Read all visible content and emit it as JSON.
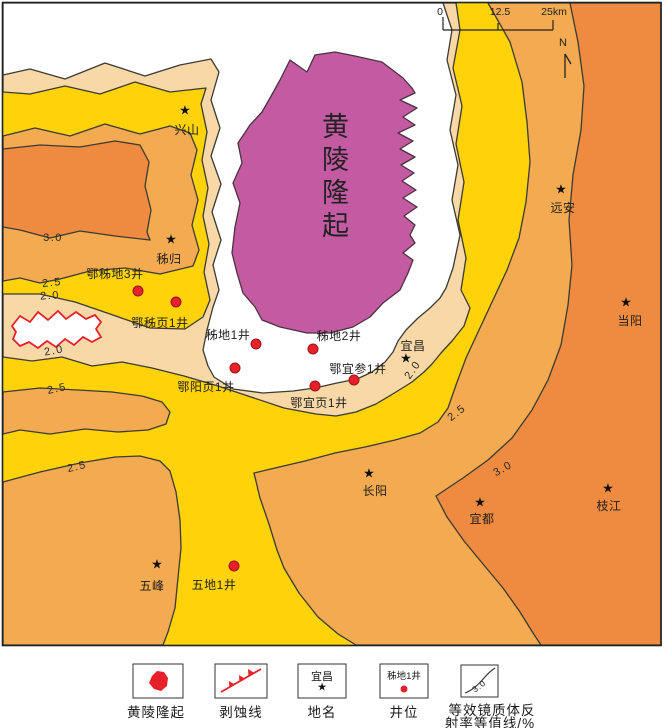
{
  "map": {
    "uplift_label": "黄陵隆起",
    "star_glyph": "★",
    "towns": [
      {
        "name": "兴山"
      },
      {
        "name": "秭归"
      },
      {
        "name": "远安"
      },
      {
        "name": "当阳"
      },
      {
        "name": "宜昌"
      },
      {
        "name": "长阳"
      },
      {
        "name": "宜都"
      },
      {
        "name": "枝江"
      },
      {
        "name": "五峰"
      }
    ],
    "wells": [
      {
        "name": "鄂秭地3井"
      },
      {
        "name": "鄂秭页1井"
      },
      {
        "name": "秭地1井"
      },
      {
        "name": "秭地2井"
      },
      {
        "name": "鄂宜参1井"
      },
      {
        "name": "鄂宜页1井"
      },
      {
        "name": "鄂阳页1井"
      },
      {
        "name": "五地1井"
      }
    ],
    "contour_labels": [
      {
        "value": "3.0"
      },
      {
        "value": "2.5"
      },
      {
        "value": "2.0"
      },
      {
        "value": "2.0"
      },
      {
        "value": "2.5"
      },
      {
        "value": "2.5"
      },
      {
        "value": "2.0"
      },
      {
        "value": "2.5"
      },
      {
        "value": "3.0"
      }
    ],
    "scale_bar": {
      "tick0": "0",
      "tick1": "12.5",
      "tick2": "25km"
    },
    "north_label": "N"
  },
  "legend": {
    "item_uplift": {
      "label": "黄陵隆起"
    },
    "item_erosion": {
      "label": "剥蚀线"
    },
    "item_place": {
      "label": "地名",
      "box_text": "宜昌"
    },
    "item_well": {
      "label": "井位",
      "box_text": "秭地1井"
    },
    "item_contour": {
      "label_line1": "等效镜质体反",
      "label_line2": "射率等值线/%",
      "box_text": "3.0"
    }
  },
  "colors": {
    "beige": "#F8D8A6",
    "yellow": "#FFD20A",
    "orange_mid": "#F3AA50",
    "orange_deep": "#EF8B40",
    "purple": "#C45AA1",
    "red": "#E62129",
    "line": "#3B3B33",
    "frame": "#222222"
  }
}
